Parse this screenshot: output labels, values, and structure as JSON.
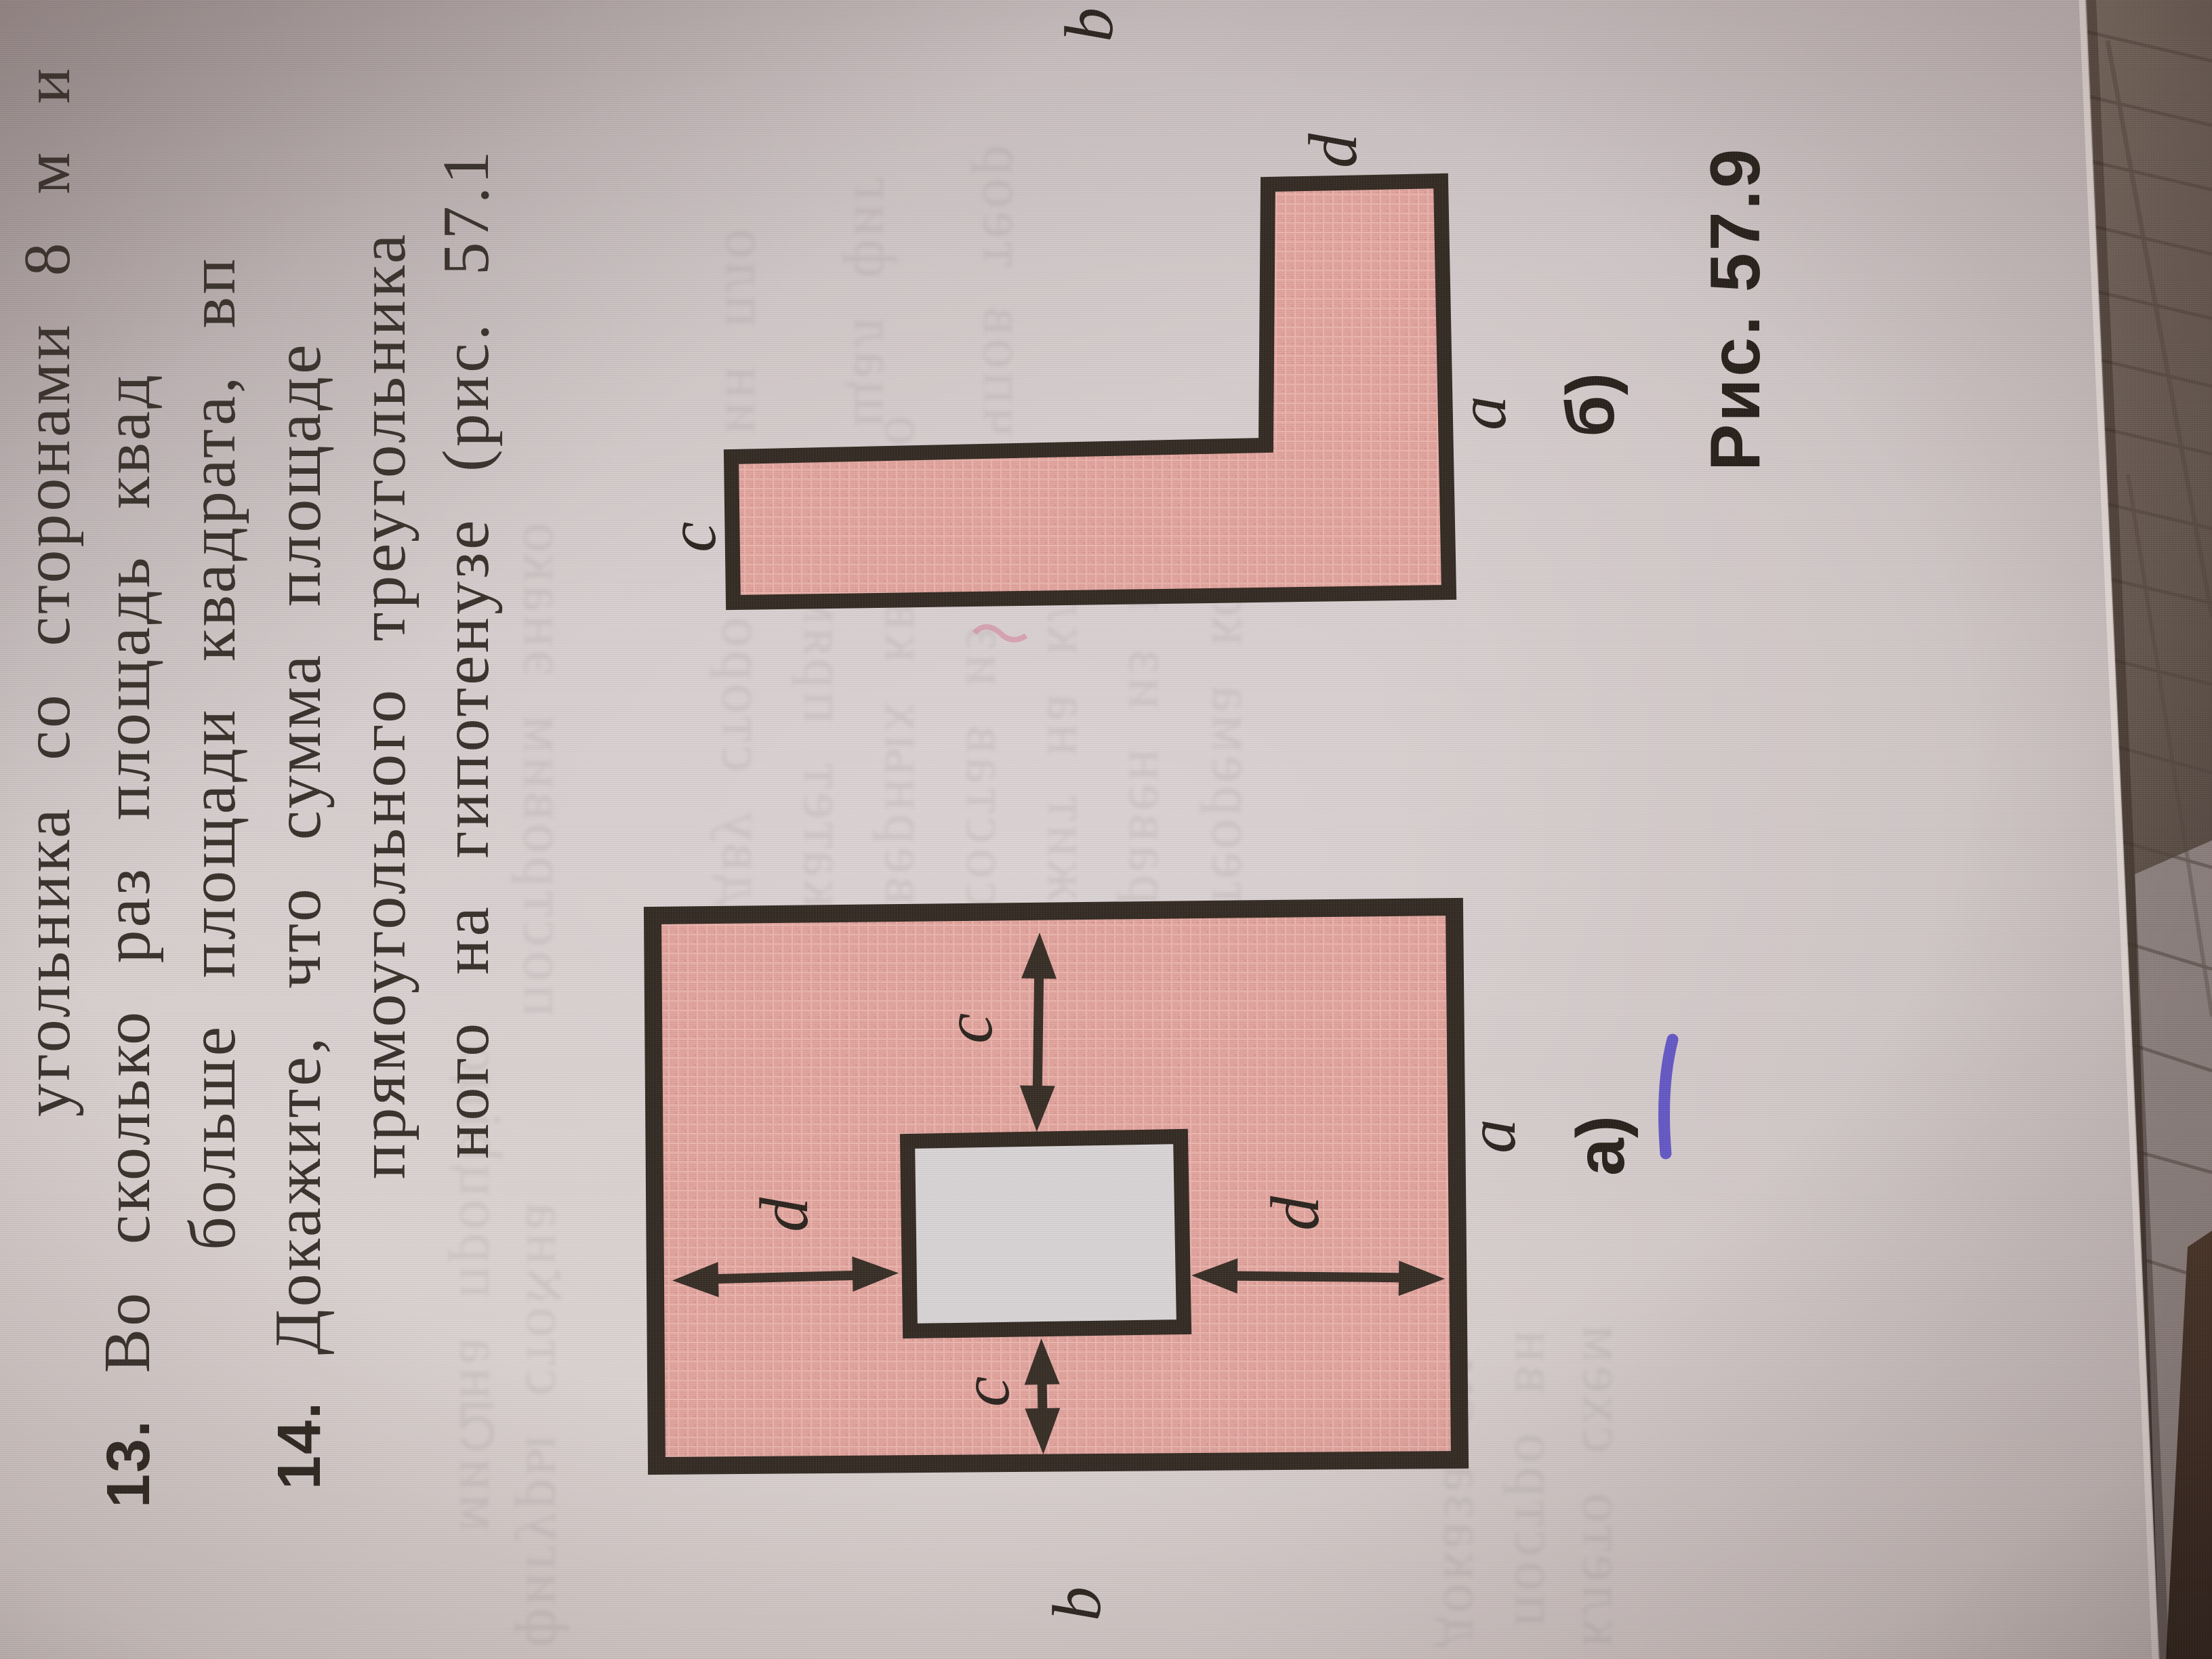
{
  "page": {
    "kind": "photo of textbook page, rotated 90 degrees",
    "problems": [
      {
        "number": "",
        "text": "угольника со сторонами 8 м и"
      },
      {
        "number": "13.",
        "text": "Во сколько раз площадь квад"
      },
      {
        "number": "",
        "text": "больше площади квадрата, вп"
      },
      {
        "number": "14.",
        "text": "Докажите, что сумма площаде"
      },
      {
        "number": "",
        "text": "прямоугольного треугольника"
      },
      {
        "number": "",
        "text": "ного на гипотенузе (рис. 57.1"
      }
    ],
    "caption": "Рис. 57.9"
  },
  "figure_a": {
    "panel_label": "а)",
    "labels": {
      "top_arrow": "c",
      "bottom_arrow": "c",
      "left_arrow": "d",
      "right_arrow": "d",
      "side_bottom": "b",
      "side_right": "a"
    },
    "description_visible": "pink rectangle with white square hole, four double-headed arrows"
  },
  "figure_b": {
    "panel_label": "б)",
    "labels": {
      "top": "b",
      "left_end": "c",
      "strip_top": "d",
      "strip_side": "a"
    },
    "description_visible": "pink L-shaped figure"
  },
  "artifacts": {
    "blue_pen_mark": true,
    "notebook_grid_beyond_page_edge": true
  },
  "colors": {
    "paper": "#d6cdce",
    "figure_fill": "#e2a59e",
    "figure_border": "#352d26",
    "ink_text": "#3b332d",
    "hole_fill": "#d9d5d7",
    "blue_mark": "#5a4ec4",
    "shadow_beyond_edge": "#5e524b"
  },
  "ghost_text_illegible": [
    "миവна процbiцα",
    "постровим энако",
    "фигуры стоאна",
    "дву сторо",
    "катет прям",
    "верных квадрато",
    "состав из н",
    "жит на клен",
    "равен из пло",
    "теорема котор",
    "ин пло",
    "щал фиг",
    "чпов теор",
    "доказа см",
    "постро вн",
    "клето схем"
  ]
}
